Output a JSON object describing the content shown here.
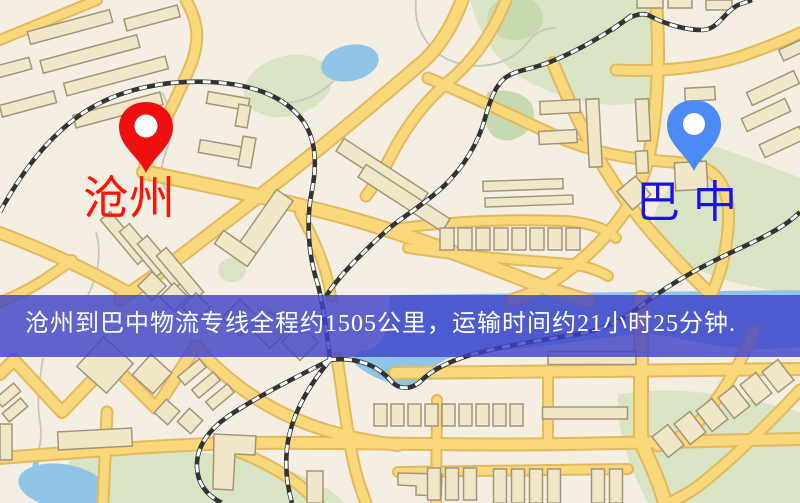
{
  "map": {
    "origin": {
      "name": "沧州",
      "label_color": "#ff1200",
      "pin_color": "#ed100e"
    },
    "destination": {
      "name": "巴中",
      "label_color": "#1a10e8",
      "pin_color": "#4c8bf5"
    }
  },
  "banner": {
    "text": "沧州到巴中物流专线全程约1505公里，运输时间约21小时25分钟.",
    "background": "rgba(60,64,200,0.8)",
    "text_color": "#ffffff"
  },
  "palette": {
    "land": "#f4efe2",
    "road_fill": "#f8d87a",
    "road_casing": "#e3b95d",
    "building_fill": "#efe7c8",
    "building_stroke": "#a3957a",
    "park": "#d8e4c4",
    "park_dark": "#c7daaf",
    "water": "#8fc6e8",
    "railway": "#333333"
  }
}
